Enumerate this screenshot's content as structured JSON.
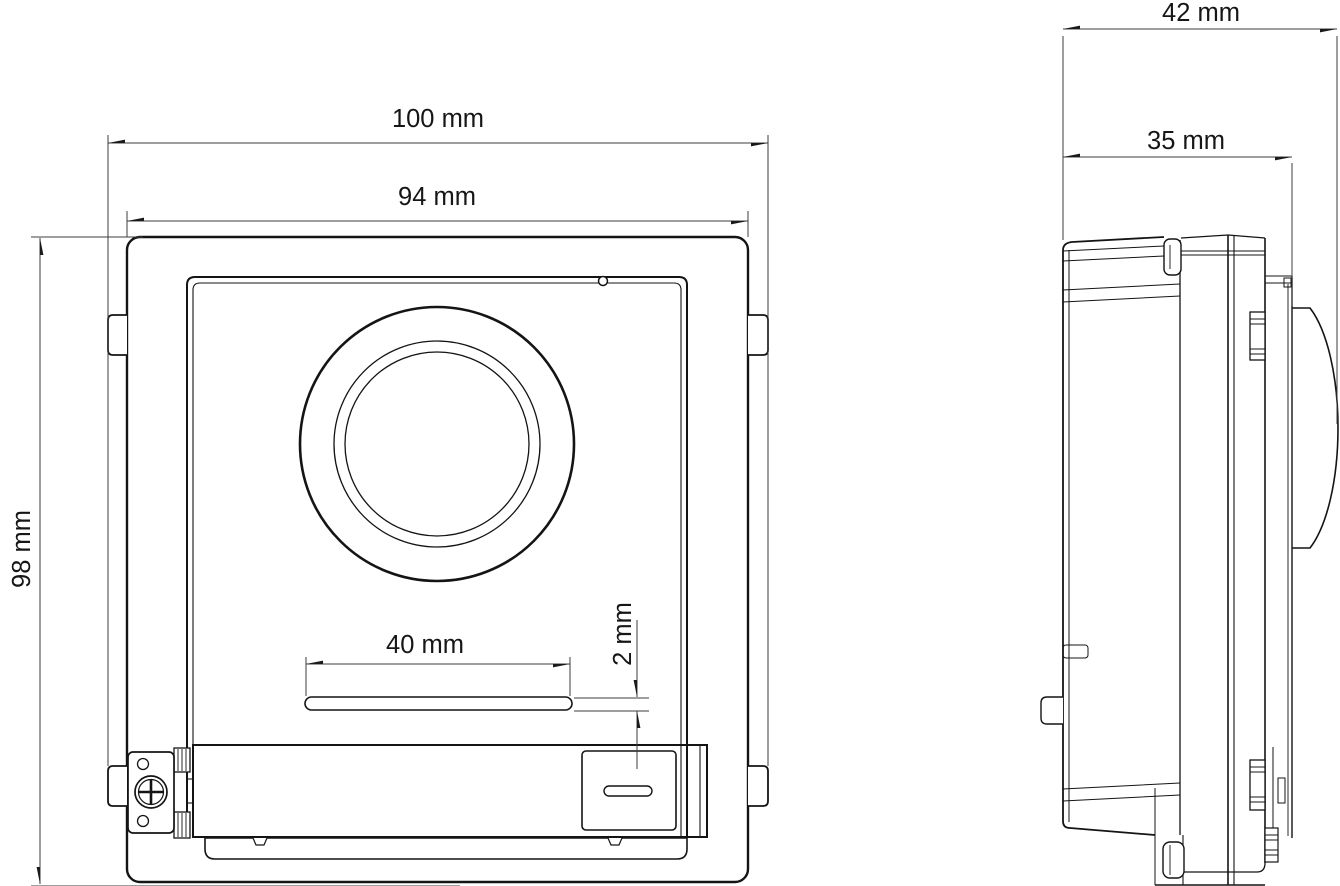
{
  "drawing": {
    "units": "mm",
    "views": {
      "front": {
        "dims": {
          "overall_width": "100 mm",
          "panel_width": "94 mm",
          "panel_height": "98 mm",
          "slot_width": "40 mm",
          "slot_height": "2 mm"
        }
      },
      "side": {
        "dims": {
          "overall_depth": "42 mm",
          "body_depth": "35 mm"
        }
      }
    },
    "colors": {
      "line": "#141414",
      "dimension": "#3d3d3d",
      "background": "#ffffff"
    }
  }
}
